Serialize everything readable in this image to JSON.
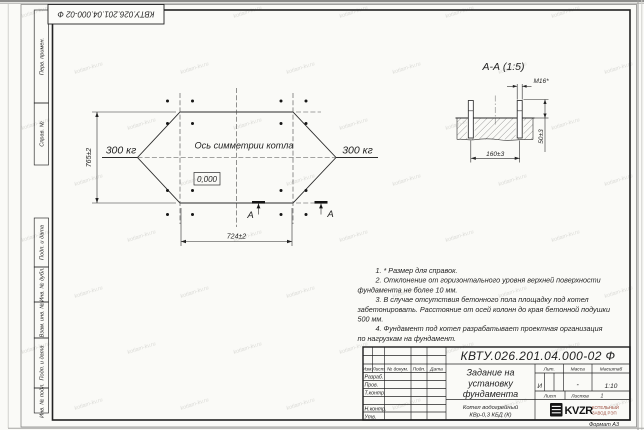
{
  "sheet": {
    "background": "#fafaf7",
    "line_color": "#2b2b2b",
    "doc_number": "КВТУ.026.201.04.000-02  Ф",
    "doc_number_rotated": "КВТУ.026.201.04.000-02 Ф",
    "format_label": "Формат А3",
    "watermark_text": "kotlam-kv.ru"
  },
  "margin_stamps": [
    {
      "label": "Перв. примен."
    },
    {
      "label": "Справ. №"
    },
    {
      "label": "Подп. и дата"
    },
    {
      "label": "Инв. № дубл."
    },
    {
      "label": "Взам. инв. №"
    },
    {
      "label": "Подп. и дата"
    },
    {
      "label": "Инв. № подл."
    }
  ],
  "plan": {
    "axis_label": "Ось симметрии котла",
    "elevation_mark": "0,000",
    "load_left": "300 кг",
    "load_right": "300 кг",
    "dim_height": "765±2",
    "dim_width": "724±2",
    "section_letter_left": "А",
    "section_letter_right": "А"
  },
  "section_view": {
    "title": "А-А  (1:5)",
    "thread_label": "М16*",
    "dim_height": "50±3",
    "dim_spacing": "160±3"
  },
  "notes": [
    "1.  * Размер для справок.",
    "2.  Отклонение от горизонтального уровня верхней поверхности",
    "фундамента не более 10 мм.",
    "3.  В случае отсутствия бетонного пола площадку под котел",
    "забетонировать. Расстояние от осей колонн до края бетонной подушки",
    "500 мм.",
    "4.  Фундамент под котел разрабатывает проектная организация",
    "по нагрузкам на фундамент."
  ],
  "title_block": {
    "columns": [
      "Изм.",
      "Лист",
      "№ докум.",
      "Подп.",
      "Дата"
    ],
    "row_labels": [
      "Разраб.",
      "Пров.",
      "Т.контр.",
      "",
      "Н.контр.",
      "Утв."
    ],
    "title_lines": [
      "Задание на",
      "установку",
      "фундамента"
    ],
    "lit_header": "Лит.",
    "mass_header": "Масса",
    "scale_header": "Масштаб",
    "lit_value": "И",
    "mass_value": "-",
    "scale_value": "1:10",
    "sheet_label": "Лист",
    "sheets_label": "Листов",
    "sheets_value": "1",
    "product_lines": [
      "Котел водогрейный",
      "КВр-0,3 КБД  (К)"
    ],
    "logo_text": "KVZR",
    "logo_caption": [
      "КОТЕЛЬНЫЙ",
      "ЗАВОД РЭП"
    ]
  }
}
